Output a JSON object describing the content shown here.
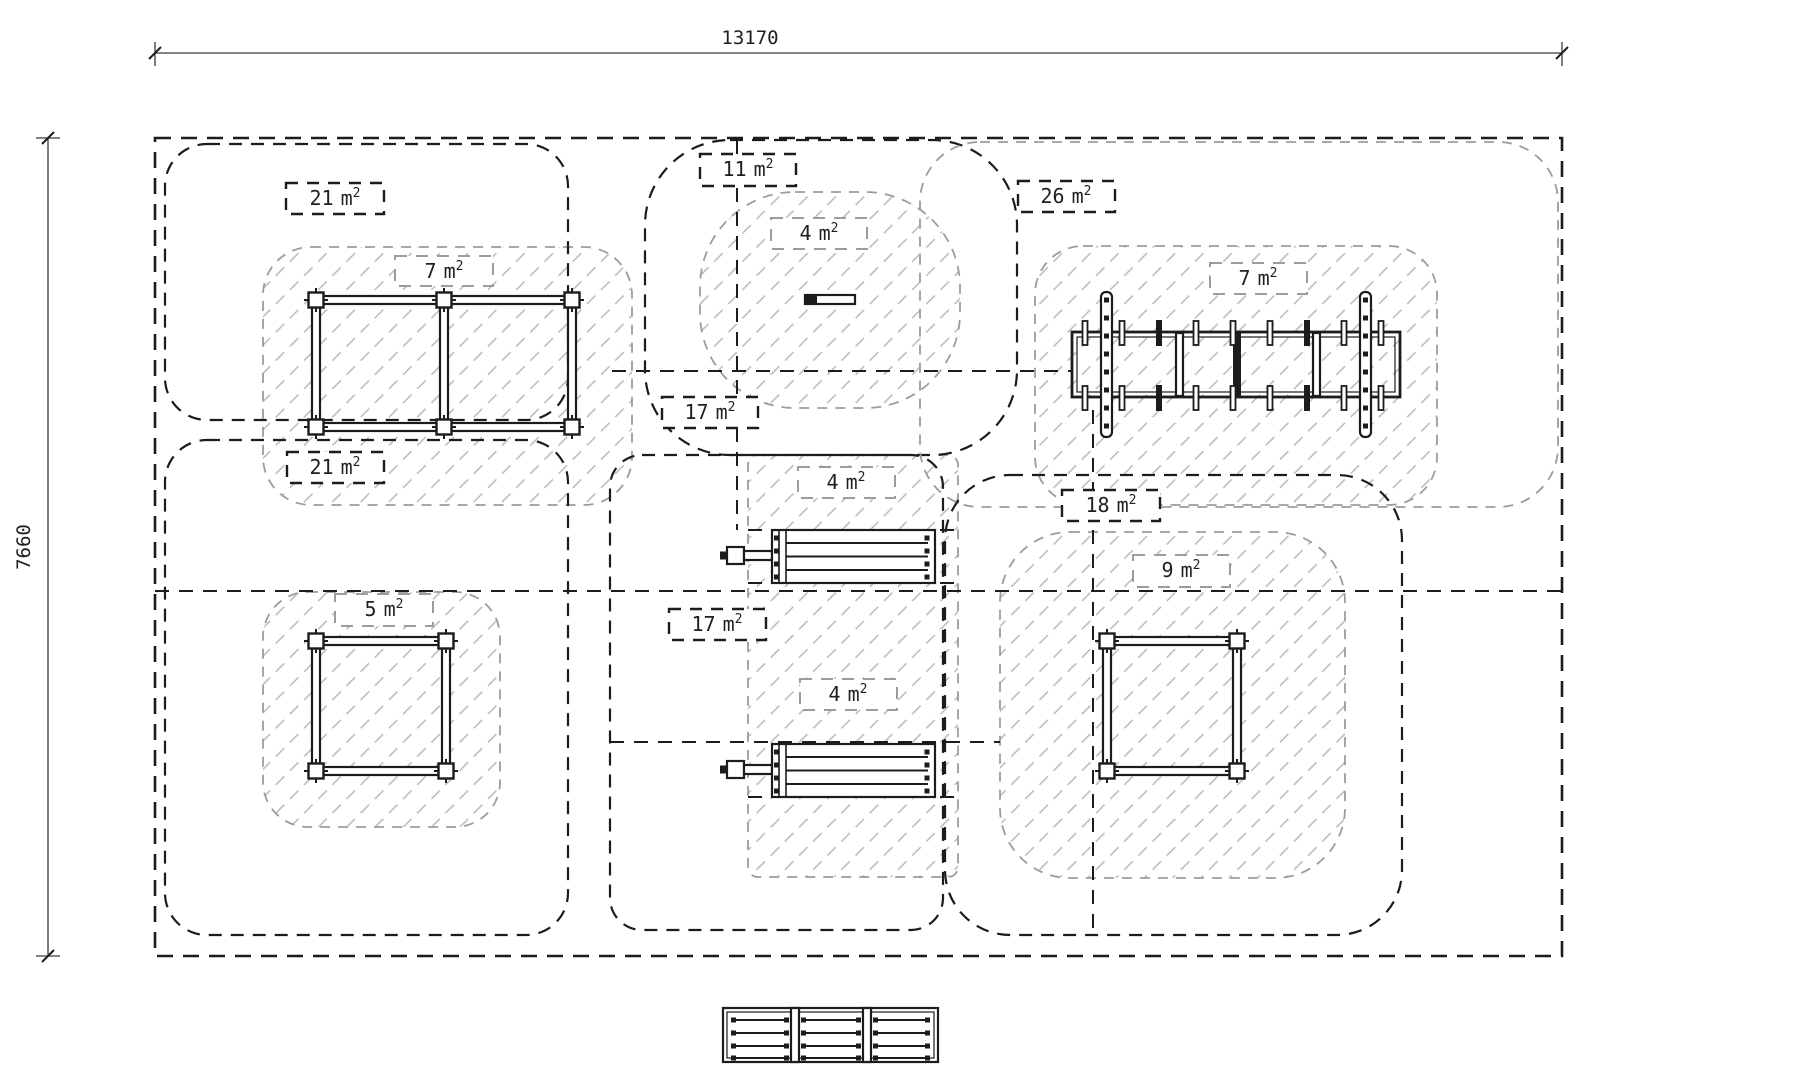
{
  "dimensions": {
    "top": "13170",
    "left": "7660"
  },
  "area_labels": [
    {
      "value": "21",
      "unit": "m",
      "sup": "2",
      "type": "zone"
    },
    {
      "value": "7",
      "unit": "m",
      "sup": "2",
      "type": "equipment"
    },
    {
      "value": "11",
      "unit": "m",
      "sup": "2",
      "type": "zone"
    },
    {
      "value": "4",
      "unit": "m",
      "sup": "2",
      "type": "equipment"
    },
    {
      "value": "26",
      "unit": "m",
      "sup": "2",
      "type": "zone"
    },
    {
      "value": "7",
      "unit": "m",
      "sup": "2",
      "type": "equipment"
    },
    {
      "value": "17",
      "unit": "m",
      "sup": "2",
      "type": "zone"
    },
    {
      "value": "21",
      "unit": "m",
      "sup": "2",
      "type": "zone"
    },
    {
      "value": "4",
      "unit": "m",
      "sup": "2",
      "type": "equipment"
    },
    {
      "value": "18",
      "unit": "m",
      "sup": "2",
      "type": "zone"
    },
    {
      "value": "9",
      "unit": "m",
      "sup": "2",
      "type": "equipment"
    },
    {
      "value": "17",
      "unit": "m",
      "sup": "2",
      "type": "zone"
    },
    {
      "value": "5",
      "unit": "m",
      "sup": "2",
      "type": "equipment"
    },
    {
      "value": "4",
      "unit": "m",
      "sup": "2",
      "type": "equipment"
    }
  ],
  "colors": {
    "line": "#1c1c1c",
    "zone_dash": "#1c1c1c",
    "equipment_dash": "#9c9c9c",
    "hatch": "#b8b8b8",
    "text": "#1f1f1f",
    "background": "#ffffff"
  }
}
